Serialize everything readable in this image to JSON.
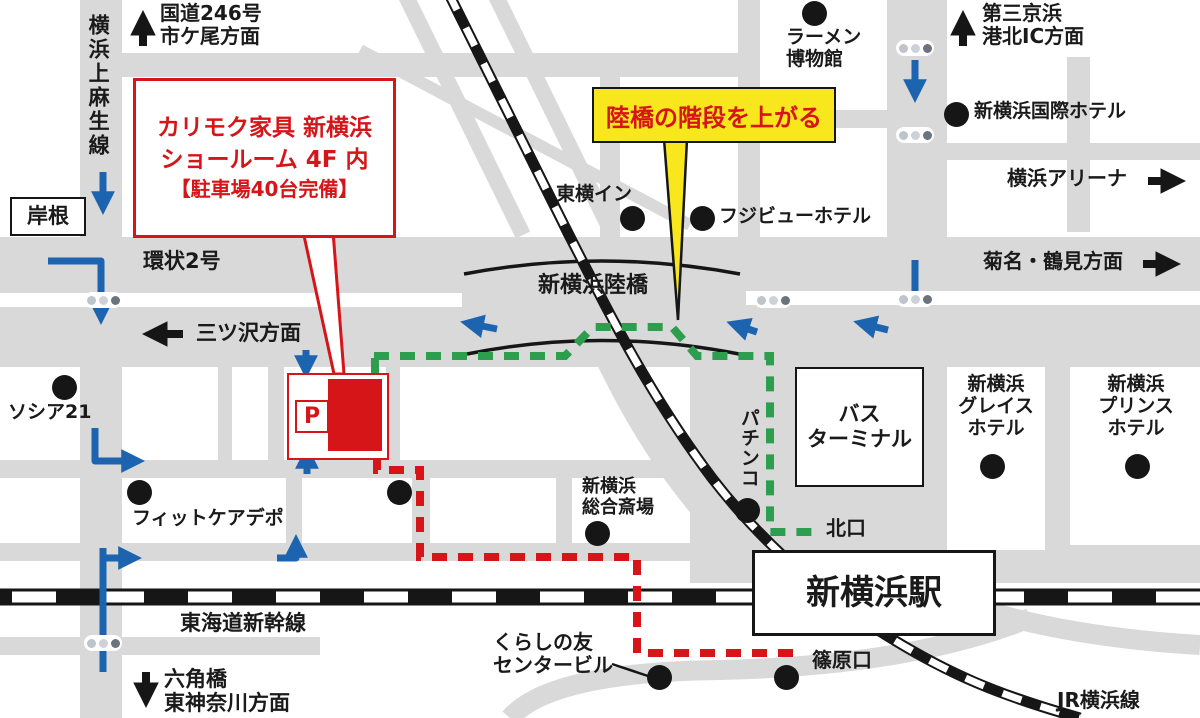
{
  "colors": {
    "road": "#d9d9d9",
    "red": "#d61518",
    "blue": "#1d64b0",
    "green": "#2d9e4e",
    "yellow": "#f7e71c",
    "ink": "#161616"
  },
  "callout": {
    "line1": "カリモク家具 新横浜",
    "line2": "ショールーム 4F 内",
    "line3": "【駐車場40台完備】"
  },
  "note": {
    "text": "陸橋の階段を上がる"
  },
  "parking": {
    "symbol": "P"
  },
  "roads": {
    "kamiasao": "横浜上麻生線",
    "route246": "国道246号",
    "ichigao": "市ケ尾方面",
    "kishine": "岸根",
    "kanjo2": "環状2号",
    "mitsuzawa": "三ツ沢方面",
    "rikkyo": "新横浜陸橋",
    "kikuna": "菊名・鶴見方面",
    "daisankeihin": "第三京浜",
    "kohokuIC": "港北IC方面",
    "shinkansen": "東海道新幹線",
    "rokkakubashi": "六角橋",
    "higashikanagawa": "東神奈川方面",
    "jryokohama": "JR横浜線"
  },
  "pois": {
    "ramen1": "ラーメン",
    "ramen2": "博物館",
    "toyokoinn": "東横イン",
    "fujiview": "フジビューホテル",
    "kokusai": "新横浜国際ホテル",
    "arena": "横浜アリーナ",
    "socia21": "ソシア21",
    "fitcare": "フィットケアデポ",
    "saijo1": "新横浜",
    "saijo2": "総合斎場",
    "pachinko": "パチンコ",
    "bus1": "バス",
    "bus2": "ターミナル",
    "grace1": "新横浜",
    "grace2": "グレイス",
    "grace3": "ホテル",
    "prince1": "新横浜",
    "prince2": "プリンス",
    "prince3": "ホテル",
    "kitaguchi": "北口",
    "station": "新横浜駅",
    "kurashino1": "くらしの友",
    "kurashino2": "センタービル",
    "shinohara": "篠原口"
  }
}
